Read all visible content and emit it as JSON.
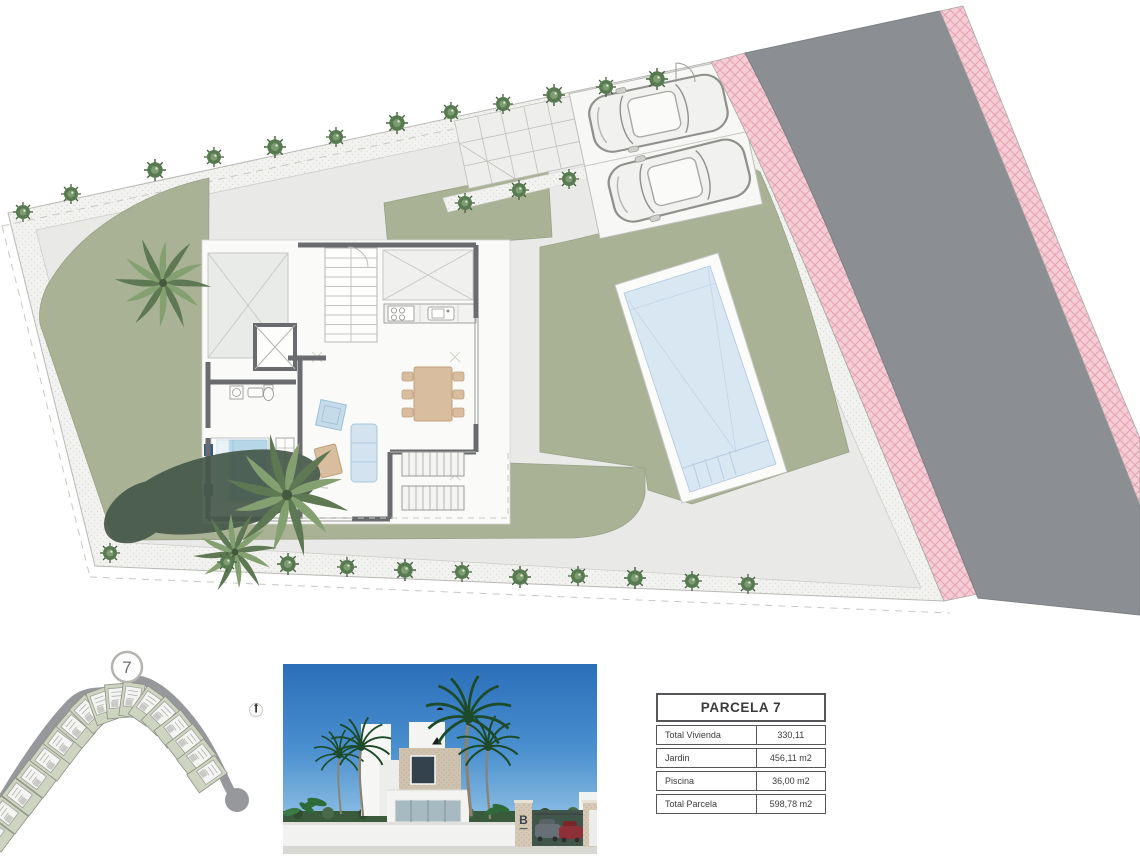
{
  "site_plan": {
    "description": "Landscaped plot plan of parcela 7 with villa floor plan, garden, pool, parking and road",
    "colors": {
      "garden_green": "#a9b295",
      "paving_gray": "#e9eae8",
      "walkway_gray": "#f2f2f0",
      "road_gray": "#8b8e92",
      "sidewalk_pink": "#f6ccd5",
      "sidewalk_hatch_pink": "#e3a3b1",
      "pool_water_blue": "#d9e7f3",
      "wall_dark_gray": "#696b6e"
    }
  },
  "locator_map": {
    "highlighted_plot_label": "7"
  },
  "villa_render": {
    "gate_logo_letter": "B",
    "sky_color": "#2a6fb9"
  },
  "info_table": {
    "title": "PARCELA 7",
    "rows": [
      {
        "label": "Total Vivienda",
        "value": "330,11"
      },
      {
        "label": "Jardin",
        "value": "456,11 m2"
      },
      {
        "label": "Piscina",
        "value": "36,00 m2"
      },
      {
        "label": "Total Parcela",
        "value": "598,78 m2"
      }
    ]
  }
}
